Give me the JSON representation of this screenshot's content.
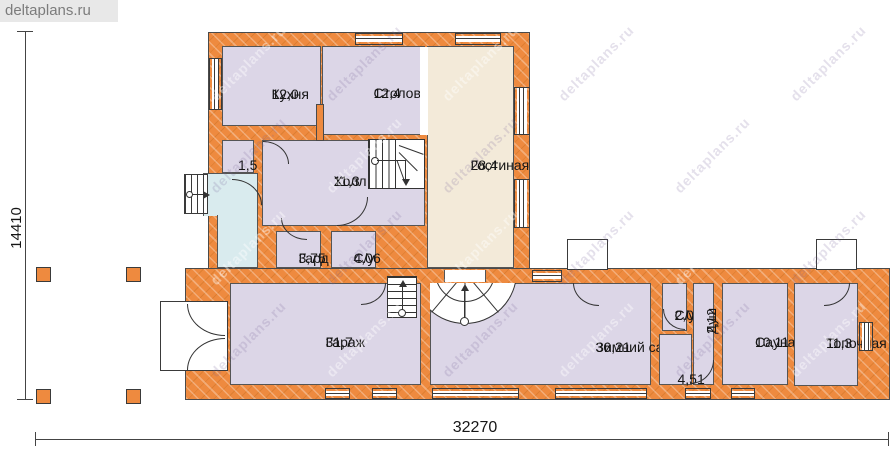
{
  "brand": {
    "label": "deltaplans.ru"
  },
  "watermark": {
    "text": "deltaplans.ru"
  },
  "dimensions": {
    "left": "14410",
    "bottom": "32270"
  },
  "rooms": [
    {
      "id": "kitchen",
      "name": "Кухня",
      "area": "12,0"
    },
    {
      "id": "dining",
      "name": "Столовая",
      "area": "12,4"
    },
    {
      "id": "living",
      "name": "Гостиная",
      "area": "28,4"
    },
    {
      "id": "closet",
      "name": "",
      "area": "1,5"
    },
    {
      "id": "hall",
      "name": "Холл",
      "area": "11,3"
    },
    {
      "id": "wardrobe",
      "name": "Гард",
      "area": "3,75"
    },
    {
      "id": "wc1",
      "name": "С/у",
      "area": "4,06"
    },
    {
      "id": "garage",
      "name": "Гараж",
      "area": "31,7"
    },
    {
      "id": "winter",
      "name": "Зимний сад",
      "area": "36,21"
    },
    {
      "id": "wc2",
      "name": "С/у",
      "area": "2,0"
    },
    {
      "id": "shower",
      "name": "Душ",
      "area": "2,12"
    },
    {
      "id": "corridor",
      "name": "",
      "area": "4,51"
    },
    {
      "id": "sauna",
      "name": "Сауна",
      "area": "10,11"
    },
    {
      "id": "boiler",
      "name": "Топочная",
      "area": "11,3"
    }
  ]
}
